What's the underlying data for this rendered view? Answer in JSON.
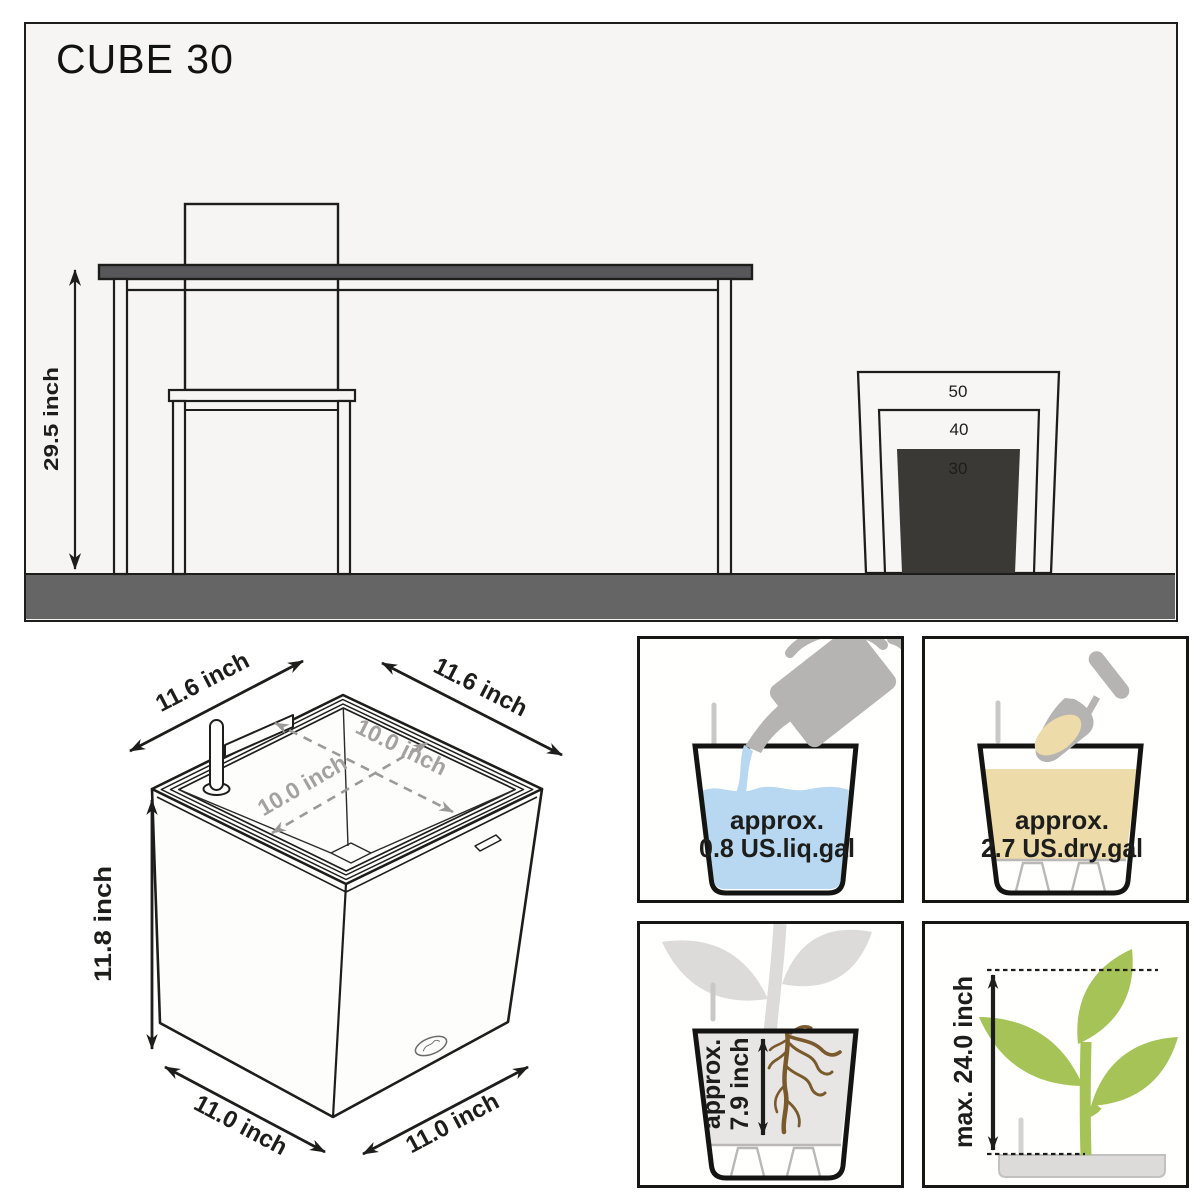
{
  "title": "CUBE 30",
  "scene": {
    "height_label": "29.5 inch",
    "cube_labels": [
      "50",
      "40",
      "30"
    ]
  },
  "iso": {
    "top_left": "11.6 inch",
    "top_right": "11.6 inch",
    "inner_a": "10.0 inch",
    "inner_b": "10.0 inch",
    "height": "11.8 inch",
    "bottom_left": "11.0 inch",
    "bottom_right": "11.0 inch"
  },
  "boxes": {
    "water": {
      "line1": "approx.",
      "line2": "0.8 US.liq.gal"
    },
    "soil": {
      "line1": "approx.",
      "line2": "2.7 US.dry.gal"
    },
    "roots": {
      "line1": "approx.",
      "line2": "7.9 inch"
    },
    "plant": {
      "label": "max. 24.0 inch"
    }
  },
  "colors": {
    "water_blue": "#b7d8f0",
    "soil_tan": "#eedbaa",
    "plant_green": "#a5c356",
    "root_brown": "#7a5a2c",
    "silhouette_gray": "#b5b4b2",
    "silhouette_light": "#dcdbda",
    "indicator_gray": "#c9c8c6",
    "floor_gray": "#656565",
    "furniture_gray": "#57575a",
    "cube_dark": "#3a3935",
    "panel_bg": "#f6f5f3",
    "ink": "#1d1d1b"
  }
}
